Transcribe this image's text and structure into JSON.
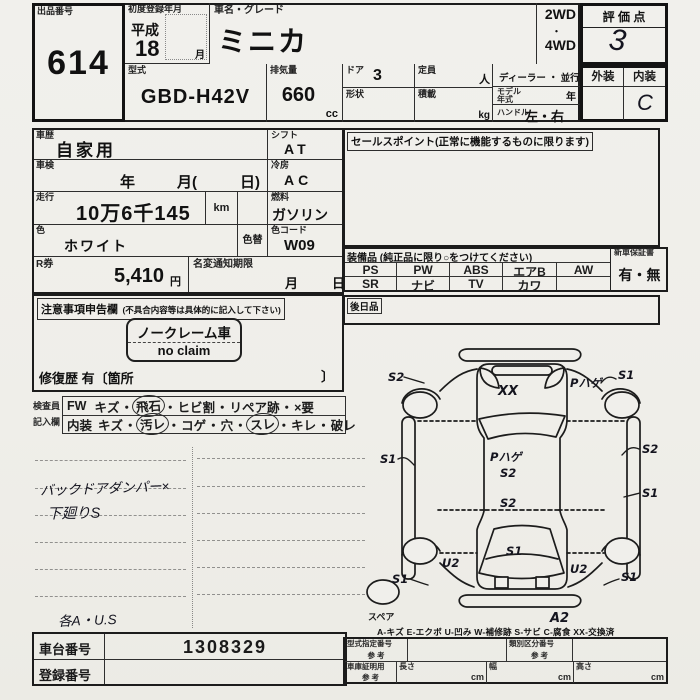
{
  "sep": "・",
  "header": {
    "lot_label": "出品番号",
    "lot_number": "614",
    "first_reg_label": "初度登録年月",
    "era": "平成",
    "reg_year": "18",
    "month_suffix": "月",
    "name_label": "車名・グレード",
    "car_name": "ミニカ",
    "drive_2wd": "2WD",
    "drive_4wd": "4WD",
    "score_label": "評 価 点",
    "score_value": "3",
    "model_label": "型式",
    "model_value": "GBD-H42V",
    "disp_label": "排気量",
    "disp_value": "660",
    "disp_unit": "cc",
    "door_label": "ドア",
    "door_value": "3",
    "shape_label": "形状",
    "capacity_label": "定員",
    "capacity_unit": "人",
    "load_label": "積載",
    "load_unit": "kg",
    "dealer_label": "ディーラー ・ 並行",
    "model_year_label1": "モデル",
    "model_year_label2": "年式",
    "model_year_unit": "年",
    "handle_label": "ハンドル",
    "handle_value": "左・右",
    "exterior_label": "外装",
    "interior_label": "内装",
    "interior_value": "C"
  },
  "left": {
    "history_label": "車歴",
    "history_value": "自家用",
    "shift_label": "シフト",
    "shift_value": "AT",
    "inspection_label": "車検",
    "insp_year": "年",
    "insp_month": "月(",
    "insp_day": "日)",
    "aircon_label": "冷房",
    "aircon_value": "AC",
    "mileage_label": "走行",
    "mileage_value": "10万6千145",
    "mileage_unit": "km",
    "fuel_label": "燃料",
    "fuel_value": "ガソリン",
    "color_label": "色",
    "color_value": "ホワイト",
    "color_change_label": "色替",
    "color_code_label": "色コード",
    "color_code_value": "W09",
    "rticket_label": "R券",
    "rticket_value": "5,410",
    "rticket_unit": "円",
    "namechange_label": "名変通知期限",
    "namechange_month": "月",
    "namechange_day": "日"
  },
  "sales_point": {
    "label": "セールスポイント(正常に機能するものに限ります)"
  },
  "equipment": {
    "label": "装備品 (純正品に限り○をつけてください)",
    "row1": [
      "PS",
      "PW",
      "ABS",
      "エアB",
      "AW"
    ],
    "row2": [
      "SR",
      "ナビ",
      "TV",
      "カワ",
      ""
    ],
    "warranty_label": "新車保証書",
    "warranty_value": "有・無",
    "later_label": "後日品"
  },
  "notes": {
    "label_main": "注意事項申告欄",
    "label_sub": "(不具合内容等は具体的に記入して下さい)",
    "stamp_line1": "ノークレーム車",
    "stamp_line2": "no claim",
    "repair_text": "修復歴  有〔箇所",
    "repair_close": "〕"
  },
  "inspector": {
    "label1": "検査員",
    "label2": "記入欄",
    "row1_prefix": "FW",
    "row1": [
      "キズ",
      "飛石",
      "ヒビ割",
      "リペア跡",
      "×要"
    ],
    "row2_prefix": "内装",
    "row2": [
      "キズ",
      "汚レ",
      "コゲ",
      "穴",
      "スレ",
      "キレ",
      "破レ"
    ]
  },
  "handwriting": {
    "note1": "バックドアダンパー×",
    "note2": "下廻りS",
    "note3": "各A・U.S"
  },
  "diagram": {
    "ann": {
      "s2_front_left": "S2",
      "xx_windshield": "XX",
      "p_hage_front_right": "Pハゲ",
      "s1_front_right": "S1",
      "s1_left_side": "S1",
      "p_hage_roof": "Pハゲ",
      "s2_roof": "S2",
      "s2_right_side": "S2",
      "s1_right_side": "S1",
      "s2_mid": "S2",
      "s1_rear_window": "S1",
      "u2_left": "U2",
      "u2_right": "U2",
      "s1_rear_left": "S1",
      "s1_rear_right": "S1",
      "a2_rear_bumper": "A2",
      "spare_label": "スペア"
    },
    "legend": "A-キズ  E-エクボ  U-凹み  W-補修跡  S-サビ  C-腐食  XX-交換済"
  },
  "bottom": {
    "chassis_label": "車台番号",
    "chassis_value": "1308329",
    "reg_label": "登録番号",
    "type_no_label": "型式指定番号",
    "class_no_label": "類別区分番号",
    "garage_label": "車庫証明用",
    "ref_label": "参 考",
    "length_label": "長さ",
    "width_label": "幅",
    "height_label": "高さ",
    "cm": "cm"
  }
}
